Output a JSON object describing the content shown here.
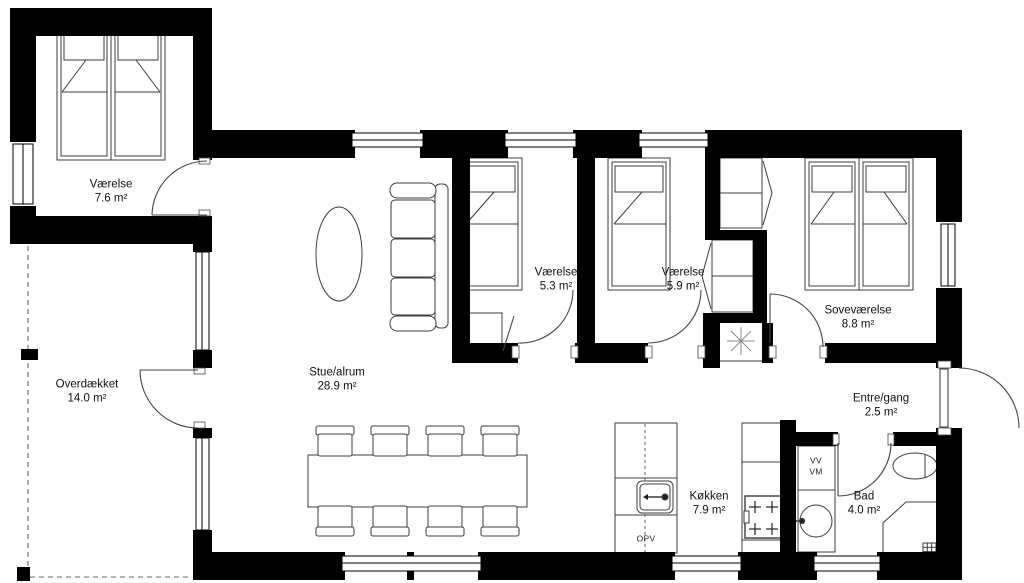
{
  "colors": {
    "wall": "#000000",
    "floor": "#ffffff",
    "furniture_line": "#3c3c3c",
    "terrace_dash": "#999999"
  },
  "rooms": {
    "vaerelse1": {
      "name": "Værelse",
      "area": "7.6 m²"
    },
    "stue": {
      "name": "Stue/alrum",
      "area": "28.9 m²"
    },
    "vaerelse2": {
      "name": "Værelse",
      "area": "5.3 m²"
    },
    "vaerelse3": {
      "name": "Værelse",
      "area": "5.9 m²"
    },
    "sovevaerelse": {
      "name": "Soveværelse",
      "area": "8.8 m²"
    },
    "overdaekket": {
      "name": "Overdækket",
      "area": "14.0 m²"
    },
    "koekken": {
      "name": "Køkken",
      "area": "7.9 m²"
    },
    "entre": {
      "name": "Entre/gang",
      "area": "2.5 m²"
    },
    "bad": {
      "name": "Bad",
      "area": "4.0 m²"
    }
  },
  "fixtures": {
    "dishwasher_label": "OPV",
    "water_heater_label": "VV",
    "washing_machine_label": "VM"
  }
}
